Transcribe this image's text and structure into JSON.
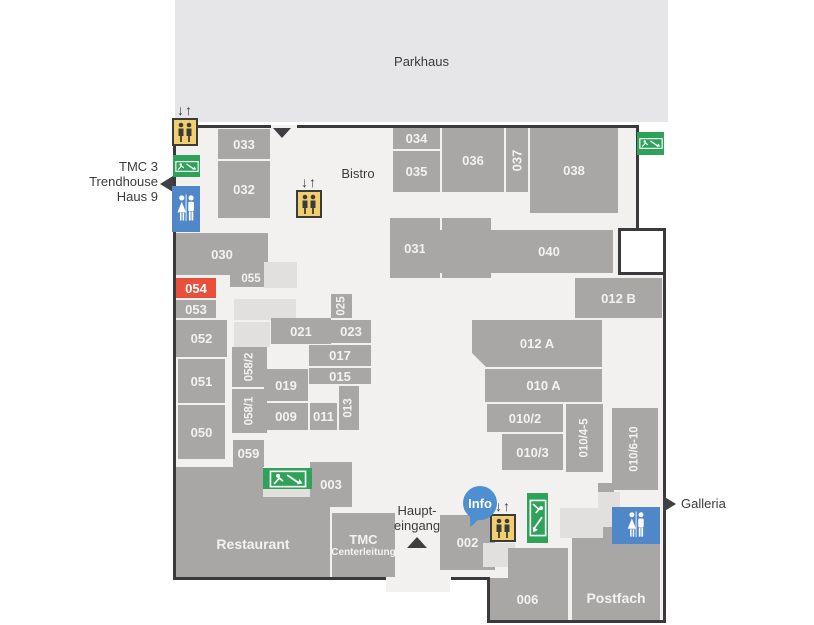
{
  "labels": {
    "parkhaus": "Parkhaus",
    "bistro": "Bistro",
    "tmc3": [
      "TMC 3",
      "Trendhouse",
      "Haus 9"
    ],
    "haupteingang": [
      "Haupt-",
      "eingang"
    ],
    "galleria": "Galleria",
    "info": "Info"
  },
  "rooms": {
    "r033": "033",
    "r032": "032",
    "r030": "030",
    "r055": "055",
    "r054": "054",
    "r053": "053",
    "r052": "052",
    "r051": "051",
    "r050": "050",
    "r059": "059",
    "r058_2": "058/2",
    "r058_1": "058/1",
    "r021": "021",
    "r025": "025",
    "r023": "023",
    "r017": "017",
    "r015": "015",
    "r019": "019",
    "r013": "013",
    "r009": "009",
    "r011": "011",
    "r034": "034",
    "r035": "035",
    "r036": "036",
    "r037": "037",
    "r038": "038",
    "r031": "031",
    "r041": "041",
    "r040": "040",
    "r012b": "012 B",
    "r012a": "012 A",
    "r010a": "010 A",
    "r010_2": "010/2",
    "r010_3": "010/3",
    "r010_45": "010/4-5",
    "r010_610": "010/6-10",
    "r003": "003",
    "r002": "002",
    "r006": "006",
    "restaurant": "Restaurant",
    "tmc_line1": "TMC",
    "tmc_line2": "Centerleitung",
    "postfach": "Postfach"
  },
  "icons": {
    "elevator_arrows": "↓↑",
    "elevator": "elevator",
    "wc": "wc",
    "emergency_exit": "emergency-exit",
    "info_marker": "info"
  },
  "colors": {
    "room_gray": "#a9a7a5",
    "room_light": "#e1e0de",
    "highlight_red": "#e8503c",
    "info_blue": "#4d8fd1",
    "wc_blue": "#4f87c8",
    "exit_green": "#2ea258",
    "elevator_yellow": "#f2cf6e",
    "wall_dark": "#3a3a3c",
    "parkhaus_gray": "#e6e5e7",
    "floor": "#f2f1ef"
  }
}
